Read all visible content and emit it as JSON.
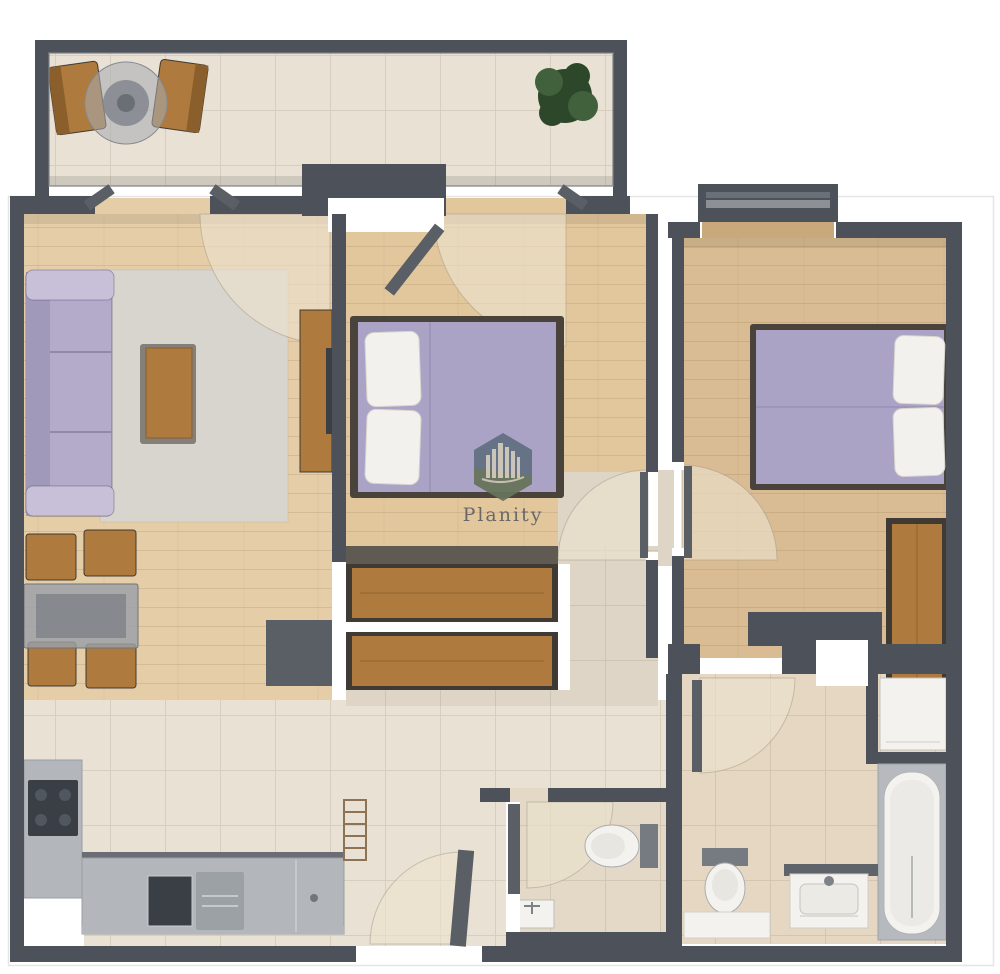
{
  "watermark": {
    "label": "Planity",
    "icon": "city-skyline-hexagon-icon"
  },
  "palette": {
    "wall": "#4d525a",
    "wallLight": "#7d8187",
    "woodLiving": "#e5cda7",
    "woodBed1": "#e2c79d",
    "woodBed2": "#d9bc93",
    "tile": "#e9e1d3",
    "tileWc": "#e3d9c6",
    "tileBath": "#e5d7c1",
    "tileHall": "#ded5c6",
    "rug": "#d8d5ce",
    "sofa": "#b3abc9",
    "sofaLight": "#c7c0d8",
    "sofaDark": "#a199ba",
    "bed": "#aba3c5",
    "pillow": "#f3f1ed",
    "bedFrame": "#4a433c",
    "woodFurn": "#ae7a3e",
    "woodFurnDark": "#8a5f2c",
    "furnOutline": "#3f3a33",
    "counter": "#b3b7bb",
    "counterLight": "#c9ccce",
    "appliance": "#3a3f45",
    "applianceLight": "#9ca1a6",
    "glassTable": "#9aa0a8",
    "glassInner": "#70767e",
    "plant": "#2d472b",
    "plantLight": "#41603c",
    "fixtureWhite": "#f4f2ee",
    "fixtureGray": "#b6babe",
    "fixtureDark": "#767b82",
    "arcFill": "#ece2cf",
    "arcLine": "#a39783",
    "doorLeaf": "#5a5f66",
    "hexTop": "#5d6c7e",
    "hexBottom": "#687457",
    "hexArt": "#d9d0c0",
    "watermarkText": "#4d535b",
    "pageBorder": "#e5e5e5"
  }
}
